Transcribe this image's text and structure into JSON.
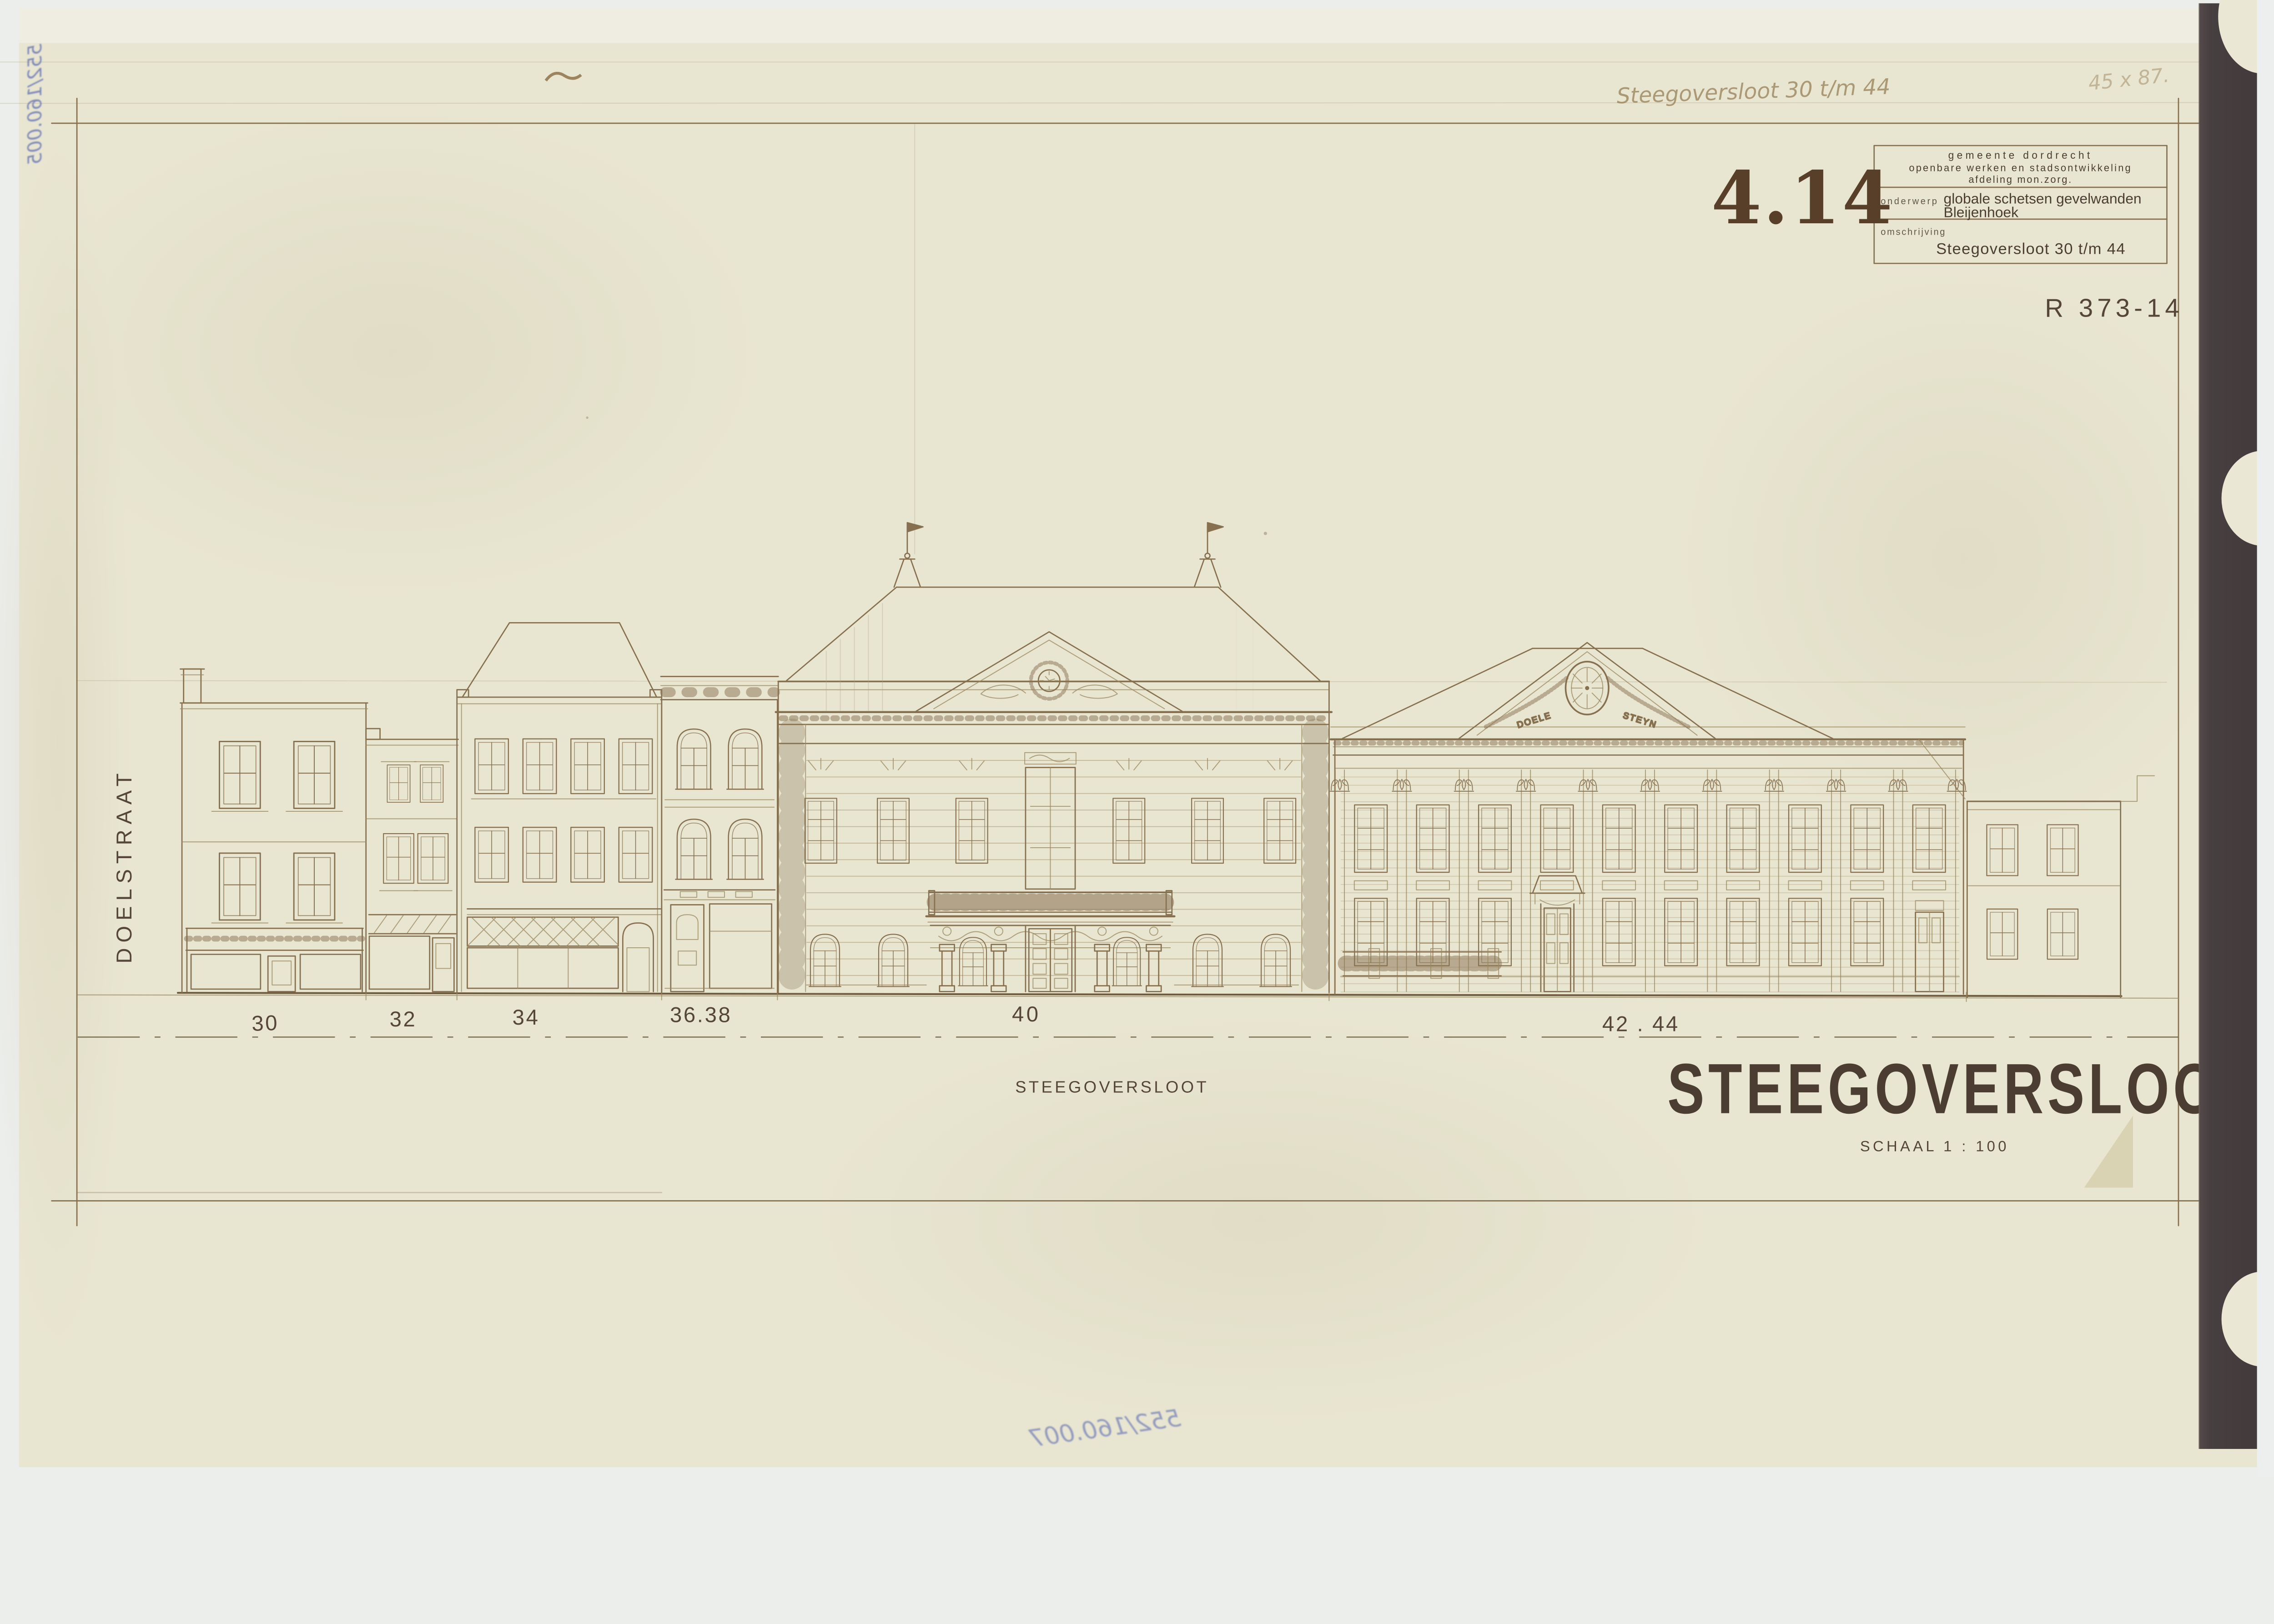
{
  "sheet": {
    "drawing_number": "4.14",
    "reference_number": "R 373-14",
    "title_block": {
      "agency_line1": "gemeente dordrecht",
      "agency_line2": "openbare werken en stadsontwikkeling",
      "agency_line3": "afdeling mon.zorg.",
      "subject_label": "onderwerp",
      "subject_line1": "globale schetsen gevelwanden",
      "subject_line2": "Bleijenhoek",
      "description_label": "omschrijving",
      "description_value": "Steegoversloot 30 t/m 44"
    },
    "main_title": "STEEGOVERSLOOT",
    "scale_label": "SCHAAL 1 : 100",
    "street_label": "STEEGOVERSLOOT",
    "cross_street_label": "DOELSTRAAT",
    "house_numbers": [
      "30",
      "32",
      "34",
      "36.38",
      "40",
      "42 . 44"
    ],
    "pediment_inscription_left": "DOELE",
    "pediment_inscription_right": "STEYN",
    "handwritten_note": "Steegoversloot 30 t/m 44",
    "handwritten_size_note": "45 x 87.",
    "inventory_note_top_left": "552/160.005",
    "inventory_note_bottom": "552/160.007"
  },
  "colors": {
    "paper": "#e8e5d1",
    "paper_edge": "#f0efe4",
    "ink_sepia": "#86704f",
    "ink_dark": "#4c3d32",
    "stamp_brown": "#573f2a",
    "blue_ink": "#5d6cb0",
    "binding_band": "#494041",
    "scan_background": "#eceeec"
  }
}
